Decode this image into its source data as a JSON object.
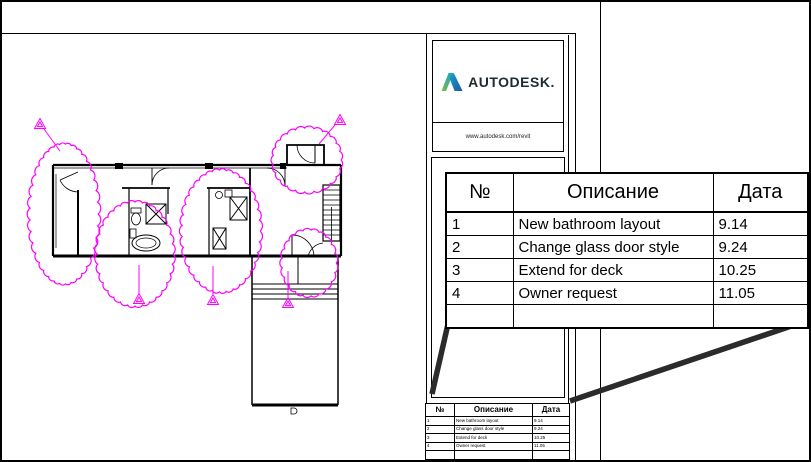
{
  "brand": {
    "name": "AUTODESK.",
    "url": "www.autodesk.com/revit"
  },
  "rev": {
    "headers": {
      "num": "№",
      "desc": "Описание",
      "date": "Дата"
    },
    "rows": [
      {
        "num": "1",
        "desc": "New bathroom layout",
        "date": "9.14"
      },
      {
        "num": "2",
        "desc": "Change glass door style",
        "date": "9.24"
      },
      {
        "num": "3",
        "desc": "Extend for deck",
        "date": "10.25"
      },
      {
        "num": "4",
        "desc": "Owner request",
        "date": "11.05"
      },
      {
        "num": "",
        "desc": "",
        "date": ""
      }
    ]
  },
  "colors": {
    "revision_cloud": "#FF00FF",
    "leader_line": "#2b2b2b",
    "logo_text": "#1e2b33",
    "logo_green": "#7AC143",
    "logo_teal": "#14A0CE",
    "logo_blue": "#2157A0"
  }
}
